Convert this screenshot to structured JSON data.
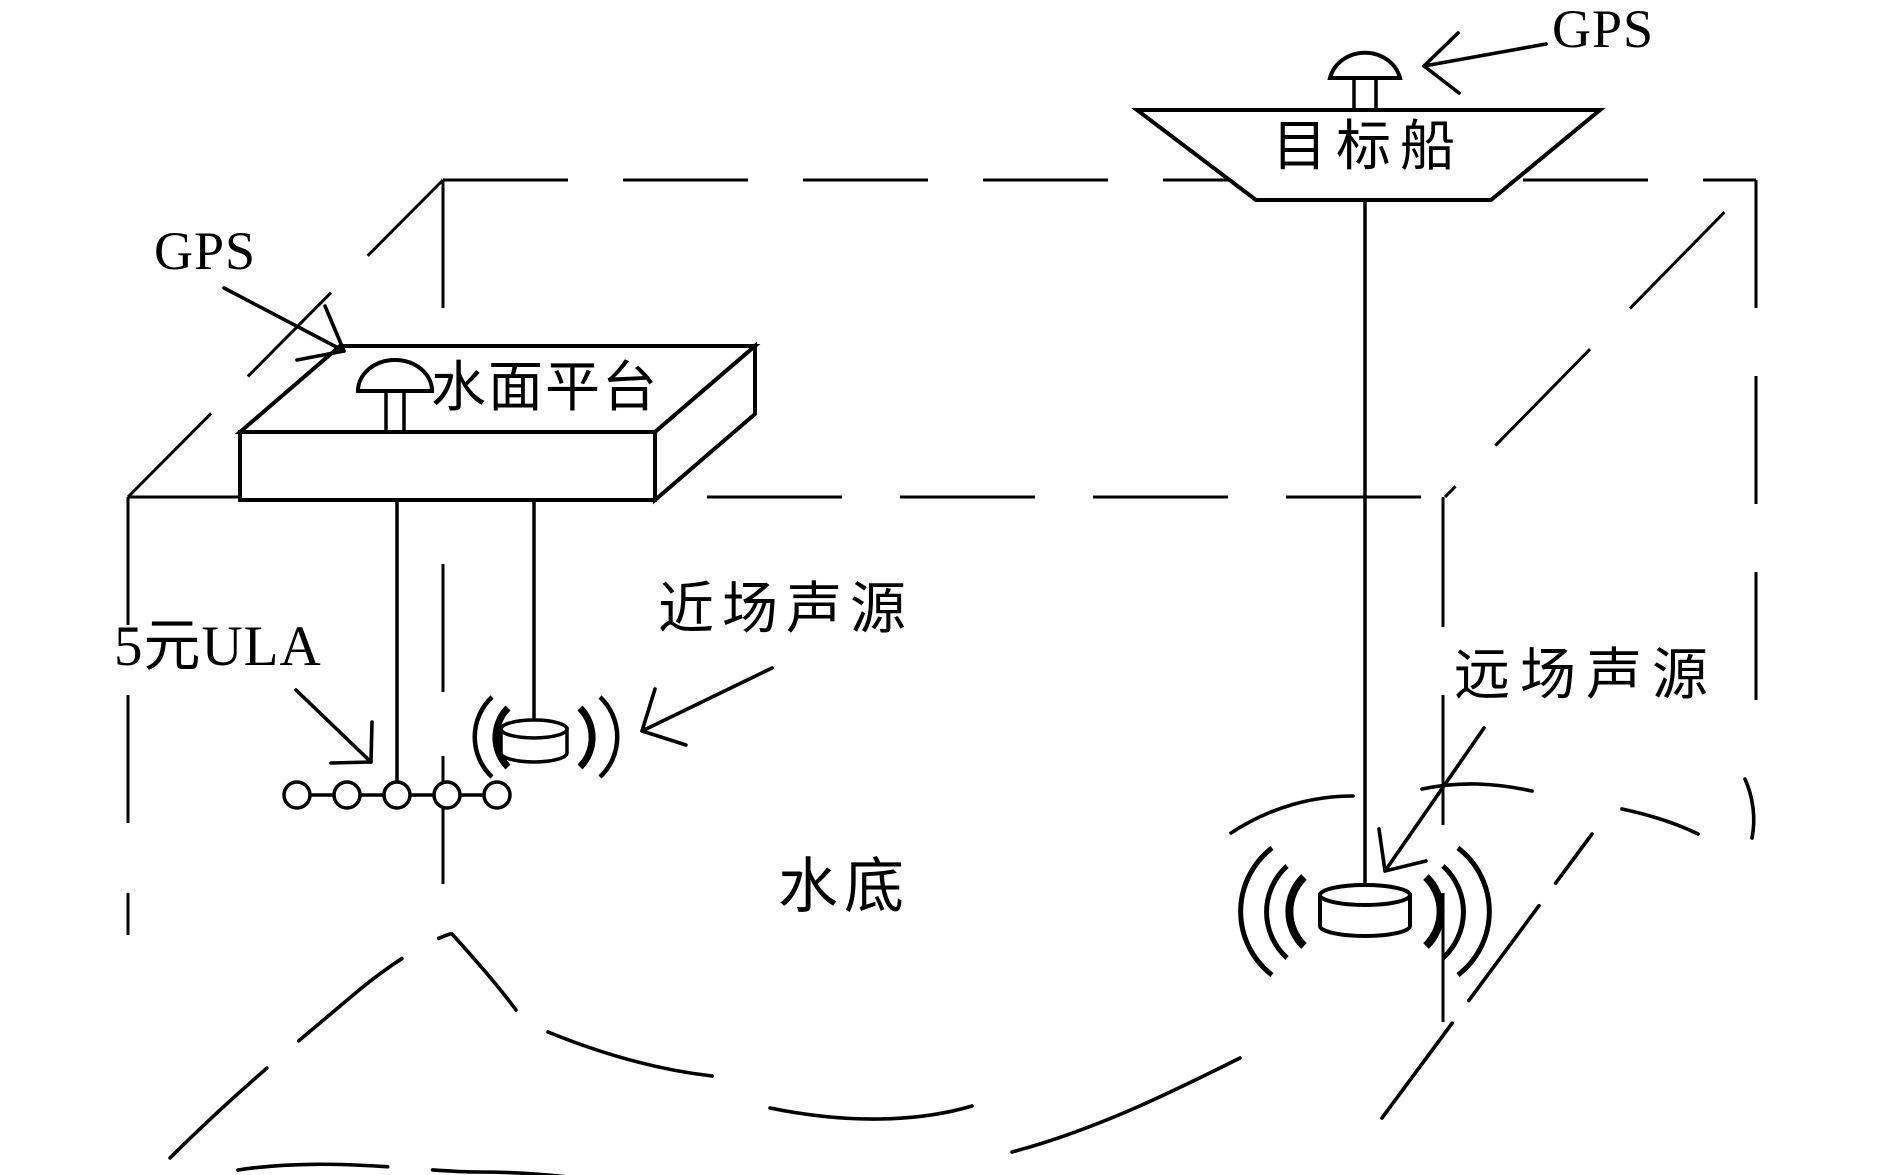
{
  "figure": {
    "type": "underwater-acoustic-experiment-schematic",
    "colors": {
      "background": "#ffffff",
      "ink": "#000000"
    },
    "labels": {
      "gps_ship": "GPS",
      "gps_platform": "GPS",
      "surface_platform": "水面平台",
      "target_ship": "目标船",
      "ula": "5元ULA",
      "near_source": "近场声源",
      "far_source": "远场声源",
      "seabed": "水底"
    },
    "icons": [
      "gps-dome-icon",
      "hydrophone-array-icon",
      "sound-source-cylinder-icon",
      "sound-wave-arcs-icon"
    ]
  }
}
